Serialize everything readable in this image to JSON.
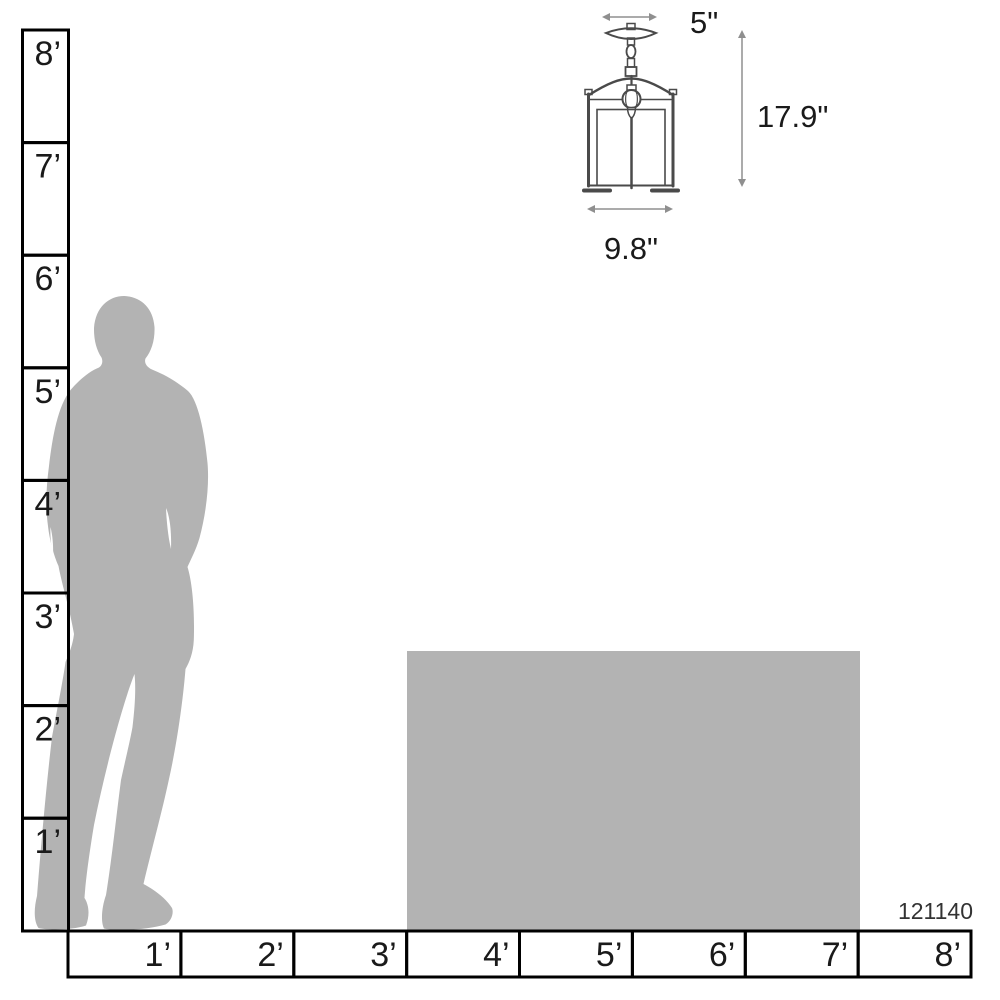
{
  "diagram": {
    "product_number": "121140",
    "fixture": {
      "type": "pendant-lantern-line-drawing",
      "dimensions": {
        "canopy_width": "5\"",
        "height": "17.9\"",
        "body_width": "9.8\""
      }
    },
    "vertical_ruler": {
      "labels": [
        "8’",
        "7’",
        "6’",
        "5’",
        "4’",
        "3’",
        "2’",
        "1’"
      ]
    },
    "horizontal_ruler": {
      "labels": [
        "1’",
        "2’",
        "3’",
        "4’",
        "5’",
        "6’",
        "7’",
        "8’"
      ]
    },
    "colors": {
      "silhouette_gray": "#b3b3b3",
      "ruler_line": "#000000",
      "fixture_line": "#4a4a4a",
      "dimension_line": "#8f8f8f",
      "label_text": "#1a1a1a"
    }
  }
}
